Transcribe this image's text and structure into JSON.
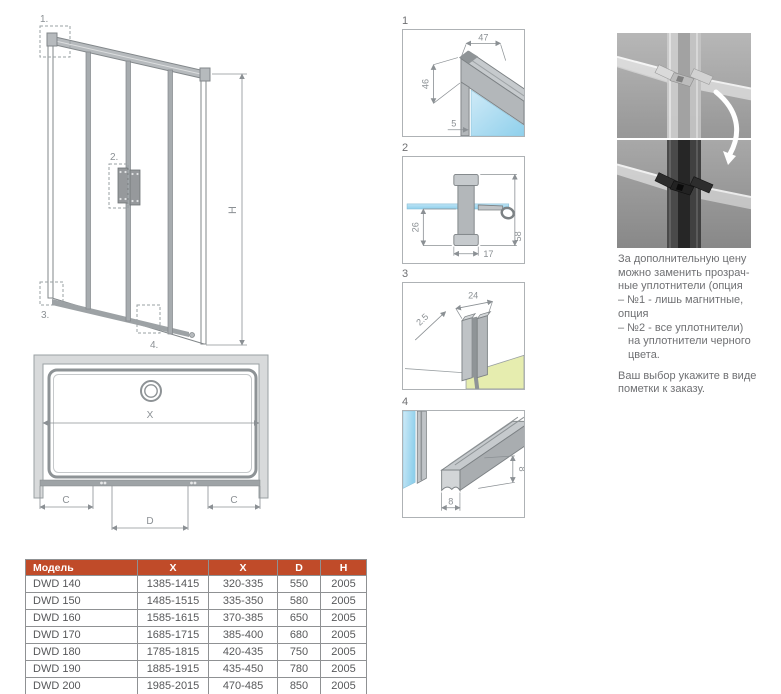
{
  "colors": {
    "accent": "#c04b29",
    "glass_blue": "#9ed7f0",
    "floor_green": "#e6edaf",
    "line_gray": "#8b9094",
    "text_gray": "#6f7073"
  },
  "main_view": {
    "callouts": {
      "c1": "1.",
      "c2": "2.",
      "c3": "3.",
      "c4": "4."
    },
    "height_label": "H"
  },
  "plan_view": {
    "width_label": "X",
    "side_left": "C",
    "side_right": "C",
    "door_label": "D"
  },
  "details": {
    "d1": {
      "num": "1",
      "dim_top": "47",
      "dim_side": "46",
      "dim_glass": "5"
    },
    "d2": {
      "num": "2",
      "dim_depth": "26",
      "dim_width": "17",
      "dim_height": "58"
    },
    "d3": {
      "num": "3",
      "dim_gap": "2.5",
      "dim_width": "24"
    },
    "d4": {
      "num": "4",
      "dim_width": "8",
      "dim_height": "8"
    }
  },
  "seal_note": {
    "p1": [
      "За дополнительную цену",
      "можно заменить прозрач-",
      "ные уплотнители (опция",
      "– №1 - лишь магнитные,",
      "опция",
      "– №2 - все уплотнители)",
      "на уплотнители черного",
      "цвета."
    ],
    "p2": [
      "Ваш выбор укажите в виде",
      "пометки к заказу."
    ]
  },
  "spec_table": {
    "headers": [
      "Модель",
      "X",
      "X",
      "D",
      "H"
    ],
    "rows": [
      [
        "DWD 140",
        "1385-1415",
        "320-335",
        "550",
        "2005"
      ],
      [
        "DWD 150",
        "1485-1515",
        "335-350",
        "580",
        "2005"
      ],
      [
        "DWD 160",
        "1585-1615",
        "370-385",
        "650",
        "2005"
      ],
      [
        "DWD 170",
        "1685-1715",
        "385-400",
        "680",
        "2005"
      ],
      [
        "DWD 180",
        "1785-1815",
        "420-435",
        "750",
        "2005"
      ],
      [
        "DWD 190",
        "1885-1915",
        "435-450",
        "780",
        "2005"
      ],
      [
        "DWD 200",
        "1985-2015",
        "470-485",
        "850",
        "2005"
      ]
    ]
  }
}
